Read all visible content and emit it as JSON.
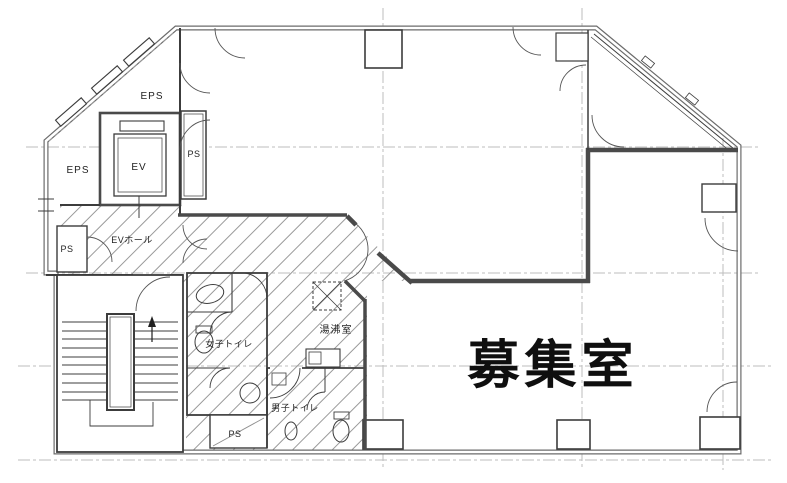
{
  "drawing": {
    "type": "architectural-floor-plan",
    "labels": {
      "eps_top": "EPS",
      "eps_left": "EPS",
      "ev": "EV",
      "ps_shaft": "PS",
      "ev_hall": "EVホール",
      "ps_left": "PS",
      "womens_toilet": "女子トイレ",
      "kitchenette": "湯沸室",
      "mens_toilet": "男子トイレ",
      "ps_bottom": "PS",
      "vacancy_room": "募集室"
    },
    "colors": {
      "background": "#ffffff",
      "wall_dark": "#4a4a4a",
      "wall_gray": "#6b6b6b",
      "thin_line": "#3c3c3c",
      "grid_line": "#bdbdbd",
      "hatch_line": "#8f8f8f",
      "text": "#1a1a1a"
    }
  }
}
